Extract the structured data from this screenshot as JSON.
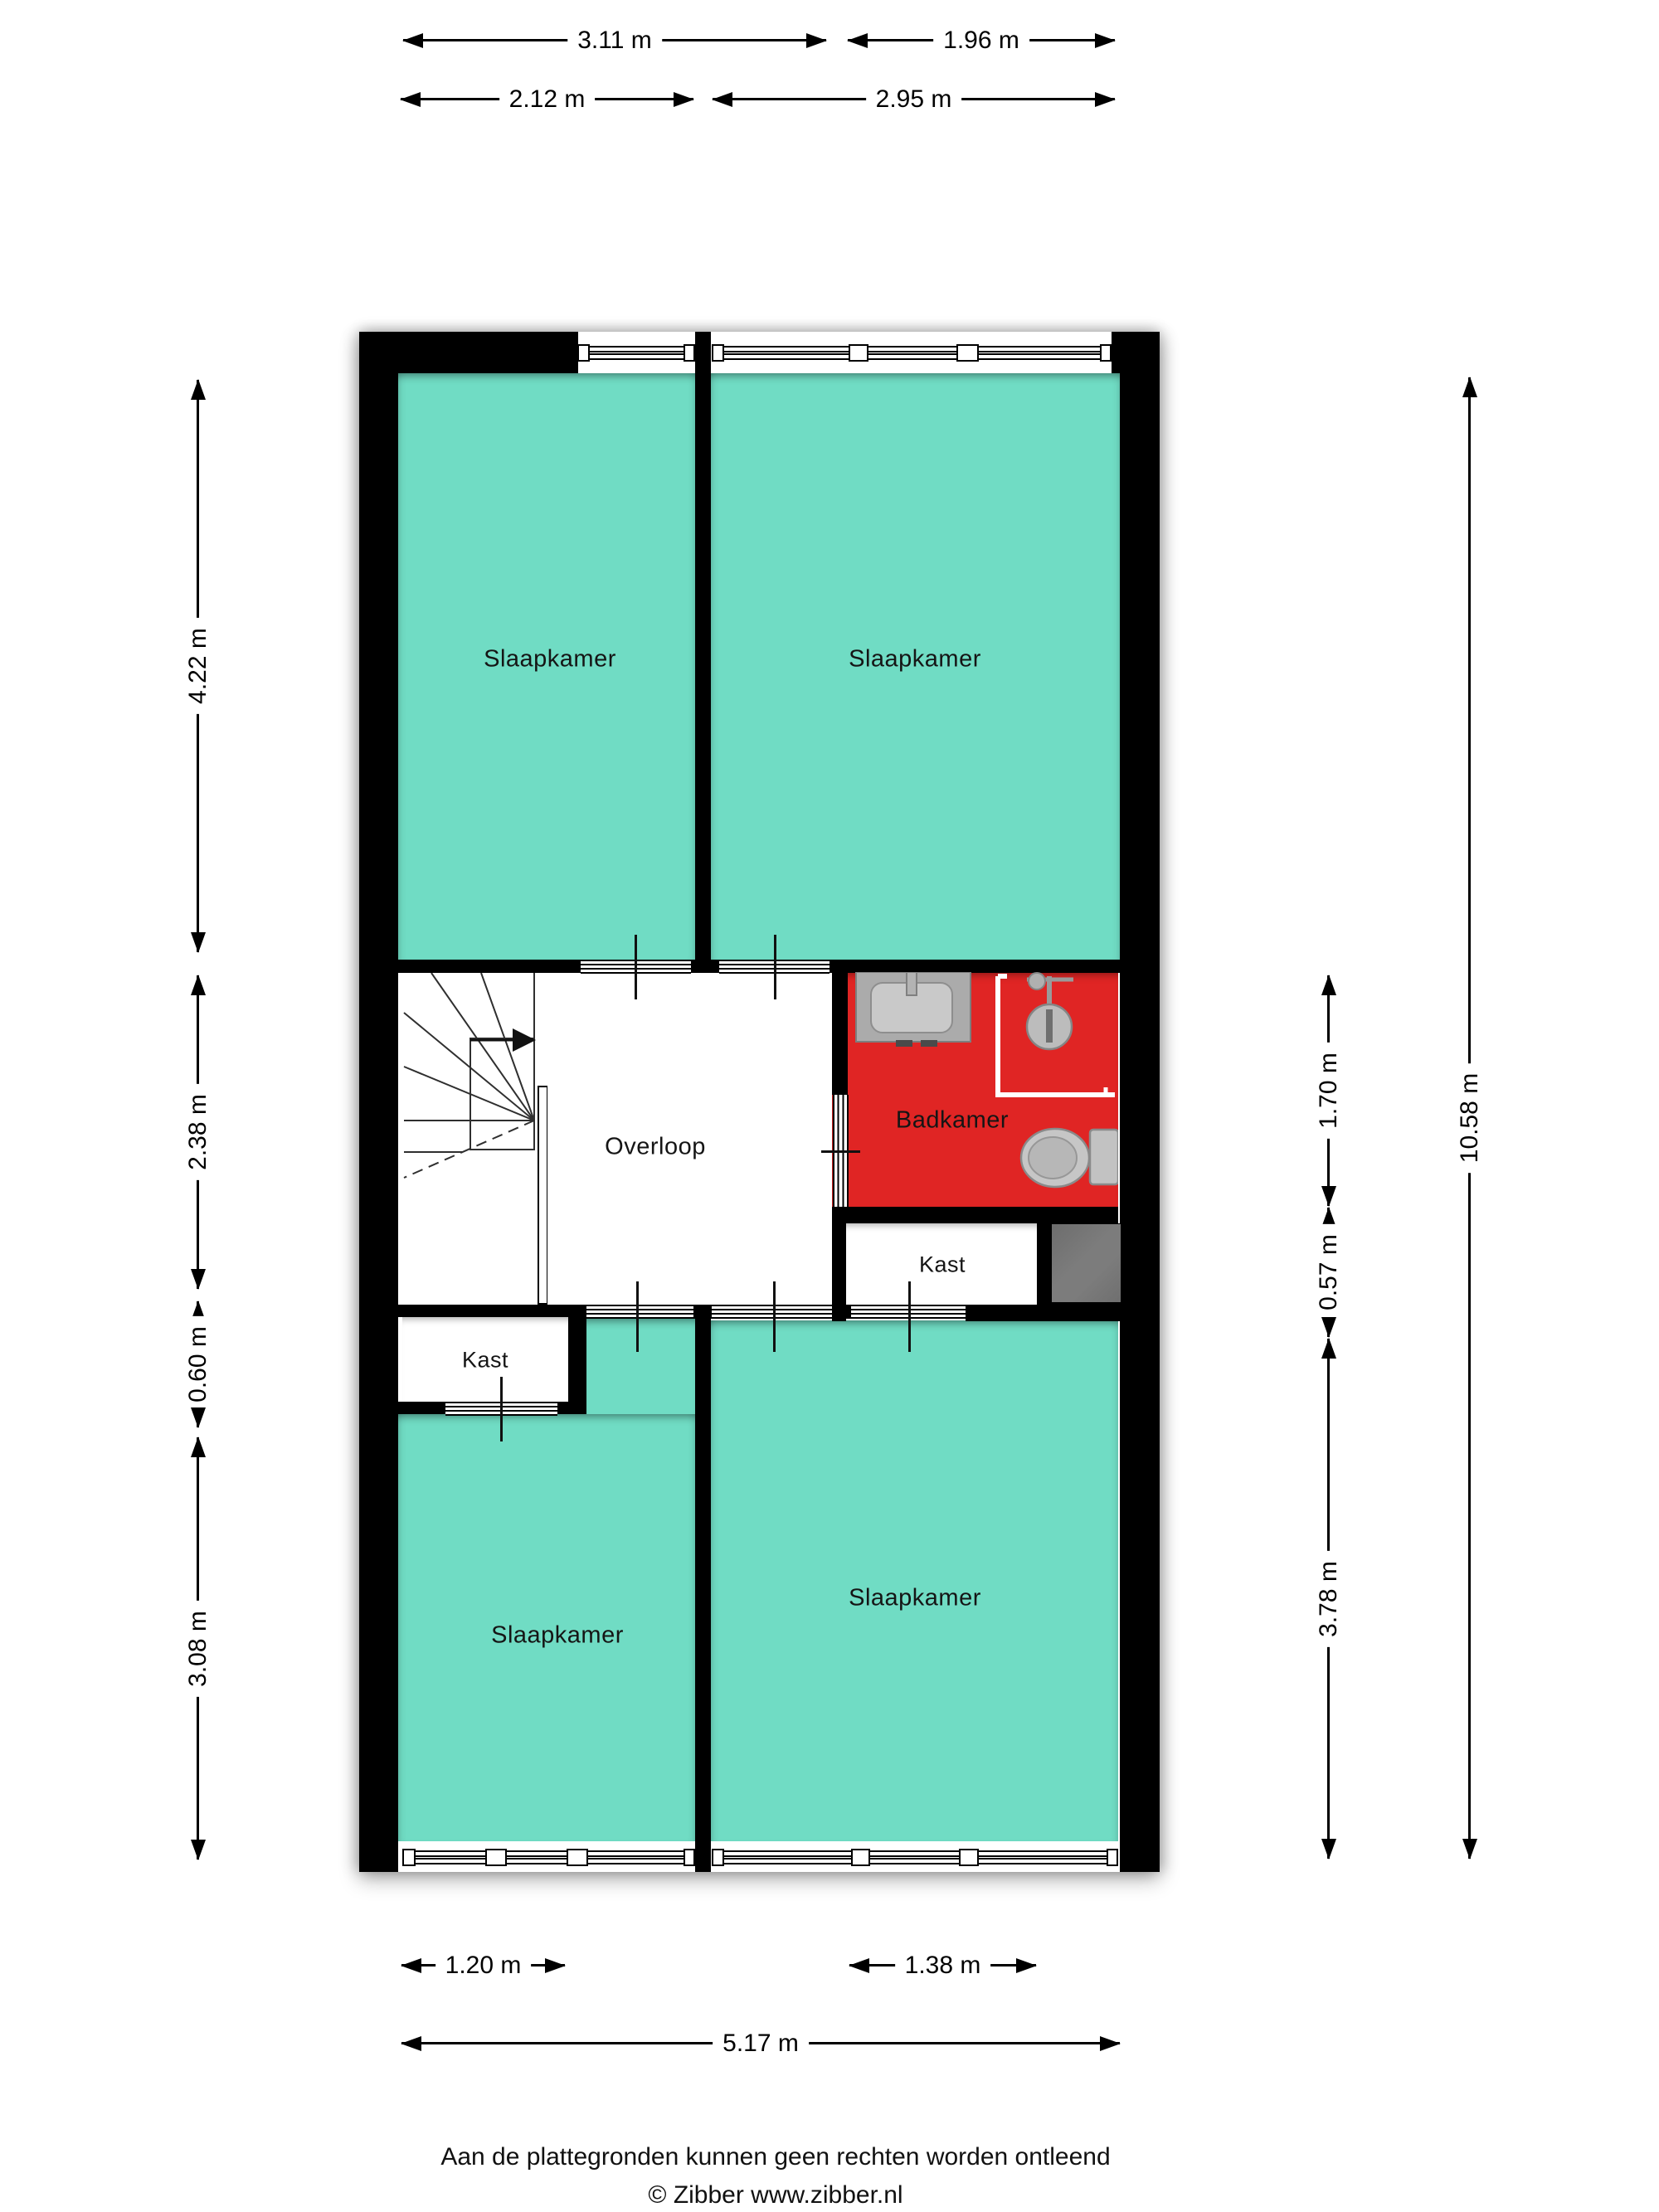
{
  "rooms": {
    "bedroom_top_left": "Slaapkamer",
    "bedroom_top_right": "Slaapkamer",
    "bedroom_bottom_left": "Slaapkamer",
    "bedroom_bottom_right": "Slaapkamer",
    "landing": "Overloop",
    "bathroom": "Badkamer",
    "closet_left": "Kast",
    "closet_right": "Kast"
  },
  "dimensions": {
    "top_row1": [
      "3.11 m",
      "1.96 m"
    ],
    "top_row2": [
      "2.12 m",
      "2.95 m"
    ],
    "left": [
      "4.22 m",
      "2.38 m",
      "0.60 m",
      "3.08 m"
    ],
    "right": [
      "1.70 m",
      "0.57 m",
      "3.78 m",
      "10.58 m"
    ],
    "bottom_row1": [
      "1.20 m",
      "1.38 m"
    ],
    "bottom_row2": [
      "5.17 m"
    ]
  },
  "fixtures": {
    "sink": "sink",
    "shower": "shower",
    "toilet": "toilet",
    "staircase": "staircase",
    "shaft": "shaft"
  },
  "footer": {
    "disclaimer": "Aan de plattegronden kunnen geen rechten worden ontleend",
    "credit": "© Zibber www.zibber.nl"
  },
  "colors": {
    "background": "#ffffff",
    "wall": "#000000",
    "room": "#70dcc4",
    "bathroom": "#e02524",
    "shaft": "#767676",
    "fixture": "#c0c0c0",
    "fixture_border": "#8a8a8a",
    "text": "#1a1a1a"
  }
}
